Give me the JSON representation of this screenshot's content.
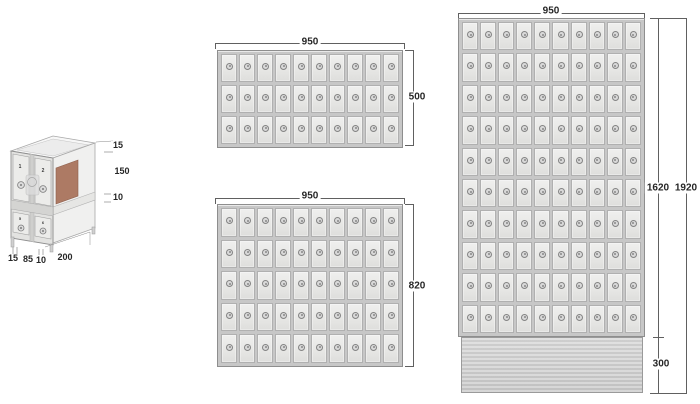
{
  "iso": {
    "door_labels": [
      "1",
      "2",
      "5",
      "6"
    ],
    "side_dims": [
      "15",
      "150",
      "10"
    ],
    "bottom_dims": [
      "15",
      "85",
      "10",
      "200"
    ],
    "interior_panel_color": "#ad7a64"
  },
  "units": [
    {
      "name": "wall-cabinet-3x10",
      "width": "950",
      "height": "500",
      "rows": 3,
      "cols": 10
    },
    {
      "name": "wall-cabinet-5x10",
      "width": "950",
      "height": "820",
      "rows": 5,
      "cols": 10
    },
    {
      "name": "floor-cabinet-10x10",
      "width": "950",
      "body_height": "1620",
      "total_height": "1920",
      "base_height": "300",
      "rows": 10,
      "cols": 10
    }
  ],
  "colors": {
    "line": "#606060",
    "text": "#262626",
    "frame": "#c7c7c7",
    "door": "#e9e9e8",
    "plinth": "#cfcfcf",
    "background": "#ffffff"
  }
}
